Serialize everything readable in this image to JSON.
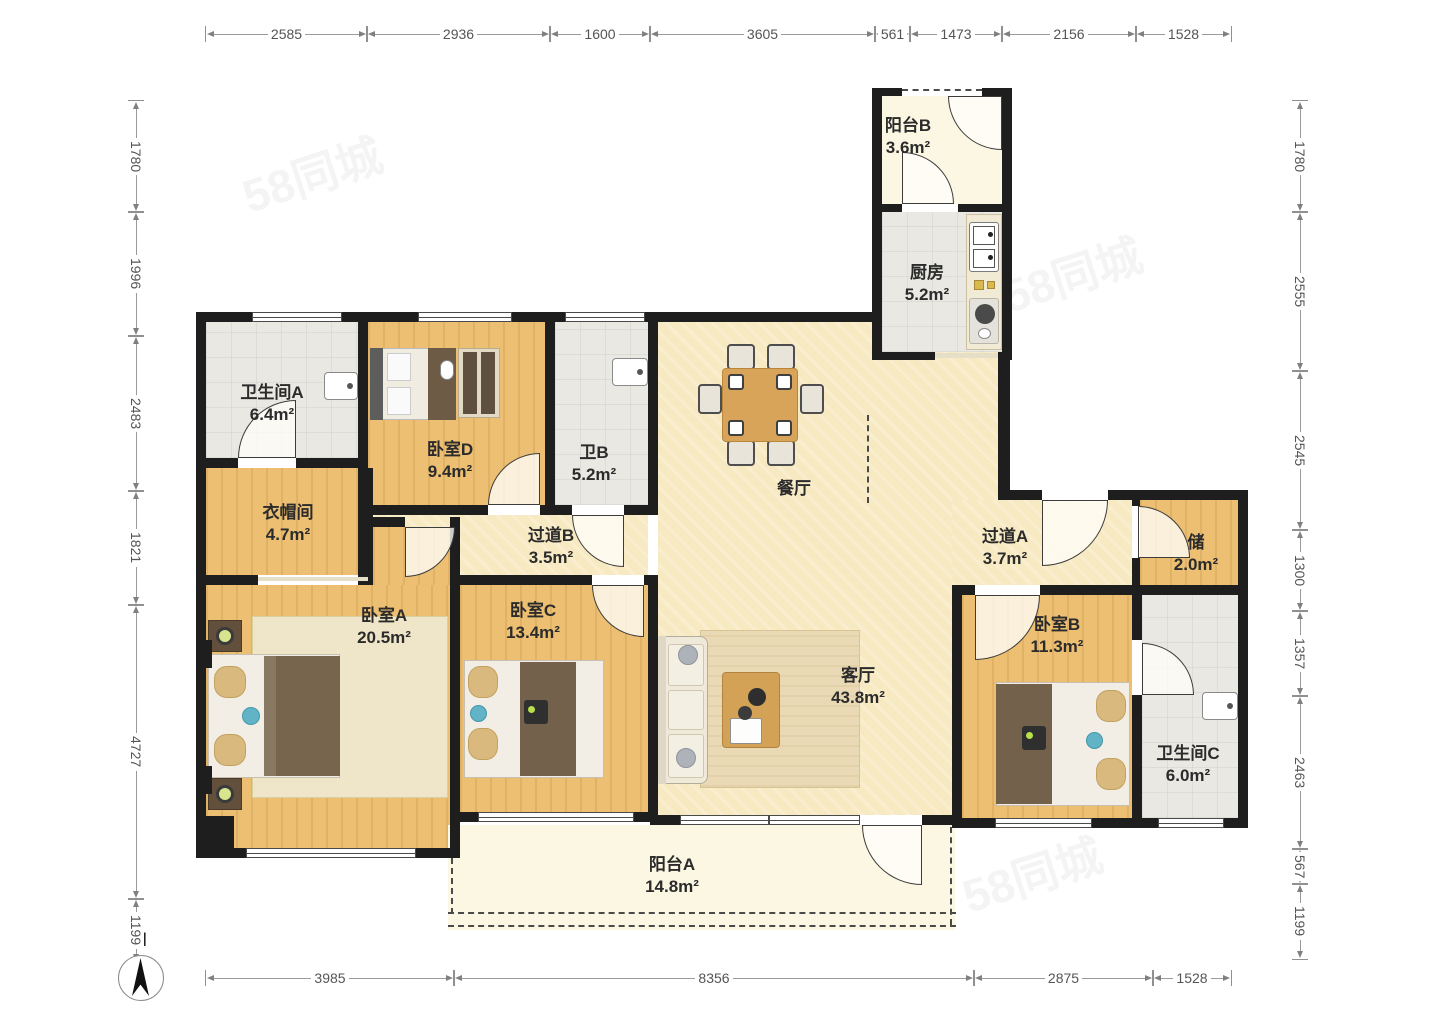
{
  "compass": {
    "label": "N"
  },
  "watermark": "58同城",
  "colors": {
    "wall": "#1e1e1e",
    "wood_floor": "#ecbf72",
    "tile_floor": "#e9e8e3",
    "living_floor": "#f7e9c1",
    "balcony_floor": "#fbf7e2",
    "dim_text": "#555555"
  },
  "rooms": [
    {
      "id": "balcony-b",
      "name": "阳台B",
      "area": "3.6m²"
    },
    {
      "id": "kitchen",
      "name": "厨房",
      "area": "5.2m²"
    },
    {
      "id": "bath-a",
      "name": "卫生间A",
      "area": "6.4m²"
    },
    {
      "id": "bed-d",
      "name": "卧室D",
      "area": "9.4m²"
    },
    {
      "id": "bath-b",
      "name": "卫B",
      "area": "5.2m²"
    },
    {
      "id": "dining",
      "name": "餐厅",
      "area": ""
    },
    {
      "id": "cloakroom",
      "name": "衣帽间",
      "area": "4.7m²"
    },
    {
      "id": "hall-b",
      "name": "过道B",
      "area": "3.5m²"
    },
    {
      "id": "hall-a",
      "name": "过道A",
      "area": "3.7m²"
    },
    {
      "id": "storage",
      "name": "储",
      "area": "2.0m²"
    },
    {
      "id": "bed-a",
      "name": "卧室A",
      "area": "20.5m²"
    },
    {
      "id": "bed-c",
      "name": "卧室C",
      "area": "13.4m²"
    },
    {
      "id": "living",
      "name": "客厅",
      "area": "43.8m²"
    },
    {
      "id": "bed-b",
      "name": "卧室B",
      "area": "11.3m²"
    },
    {
      "id": "bath-c",
      "name": "卫生间C",
      "area": "6.0m²"
    },
    {
      "id": "balcony-a",
      "name": "阳台A",
      "area": "14.8m²"
    }
  ],
  "dimensions": {
    "top": [
      "2585",
      "2936",
      "1600",
      "3605",
      "561",
      "1473",
      "2156",
      "1528"
    ],
    "bottom": [
      "3985",
      "8356",
      "2875",
      "1528"
    ],
    "left": [
      "1780",
      "1996",
      "2483",
      "1821",
      "4727",
      "1199"
    ],
    "right": [
      "1780",
      "2555",
      "2545",
      "1300",
      "1357",
      "2463",
      "567",
      "1199"
    ]
  }
}
